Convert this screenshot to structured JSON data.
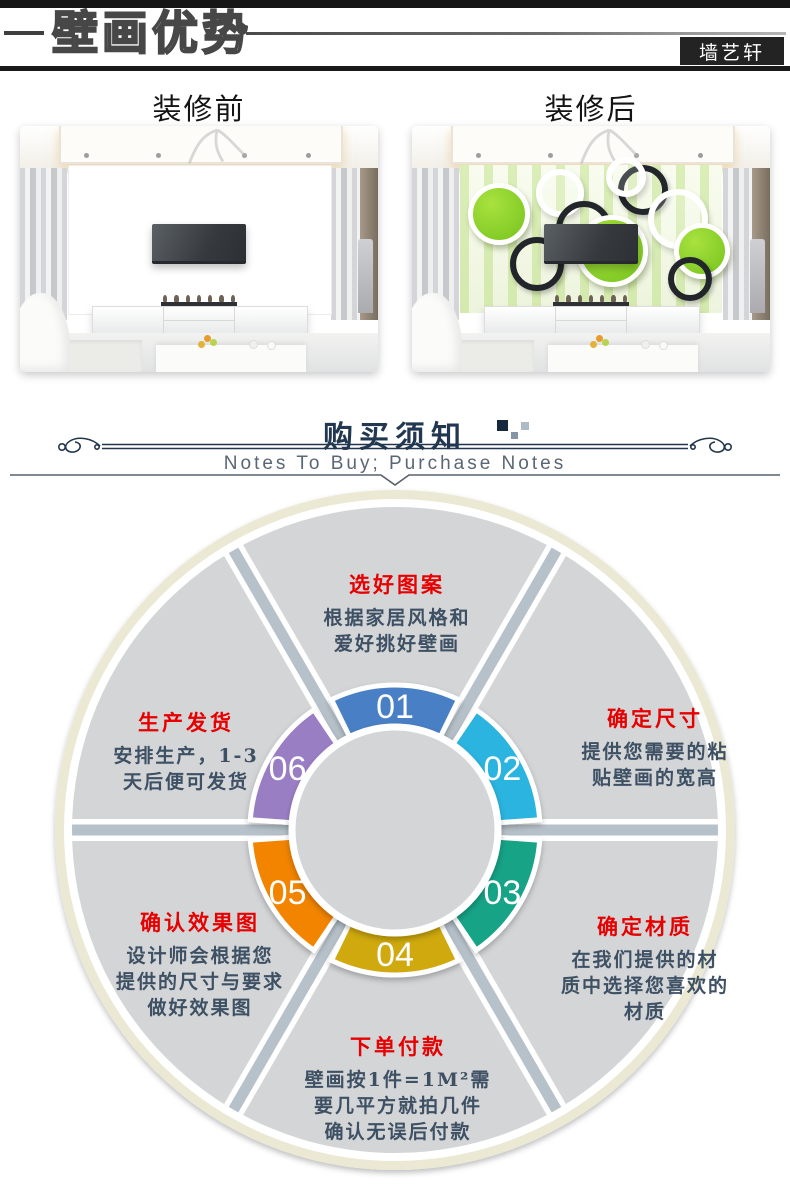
{
  "header": {
    "title": "壁画优势",
    "brand_badge": "墙艺轩"
  },
  "comparison": {
    "before_label": "装修前",
    "after_label": "装修后"
  },
  "purchase_notes": {
    "title_cn": "购买须知",
    "subtitle_en": "Notes To Buy; Purchase Notes",
    "accent_color": "#223850"
  },
  "process_wheel": {
    "title_color": "#e60000",
    "body_color": "#3e5063",
    "disc_color": "#d3d5d7",
    "divider_color": "#b6c1ca",
    "outer_ring_color": "#ebe8d4",
    "steps": [
      {
        "number": "01",
        "title": "选好图案",
        "color": "#4a80c5",
        "lines": [
          "根据家居风格和",
          "爱好挑好壁画"
        ]
      },
      {
        "number": "02",
        "title": "确定尺寸",
        "color": "#2ab4df",
        "lines": [
          "提供您需要的粘",
          "贴壁画的宽高"
        ]
      },
      {
        "number": "03",
        "title": "确定材质",
        "color": "#13a386",
        "lines": [
          "在我们提供的材",
          "质中选择您喜欢的",
          "材质"
        ]
      },
      {
        "number": "04",
        "title": "下单付款",
        "color": "#cfa90f",
        "lines": [
          "壁画按1件=1M²需",
          "要几平方就拍几件",
          "确认无误后付款"
        ]
      },
      {
        "number": "05",
        "title": "确认效果图",
        "color": "#f28404",
        "lines": [
          "设计师会根据您",
          "提供的尺寸与要求",
          "做好效果图"
        ]
      },
      {
        "number": "06",
        "title": "生产发货",
        "color": "#9a7ec4",
        "lines": [
          "安排生产，1-3",
          "天后便可发货"
        ]
      }
    ]
  }
}
